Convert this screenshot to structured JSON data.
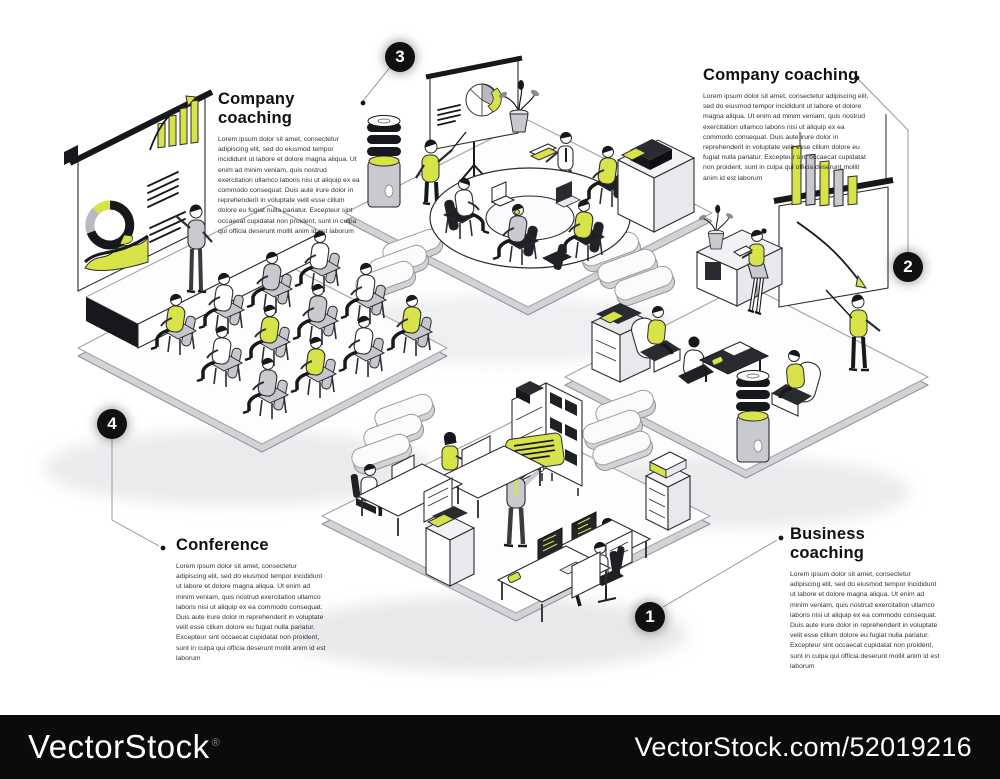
{
  "callouts": [
    {
      "number": "3",
      "title": "Company coaching",
      "body": "Lorem ipsum dolor sit amet, consectetur adipiscing elit, sed do eiusmod tempor incididunt ut labore et dolore magna aliqua. Ut enim ad minim veniam, quis nostrud exercitation ullamco laboris nisi ut aliquip ex ea commodo consequat. Duis aute irure dolor in reprehenderit in voluptate velit esse cillum dolore eu fugiat nulla pariatur. Excepteur sint occaecat cupidatat non proident, sunt in culpa qui officia deserunt mollit anim id est laborum"
    },
    {
      "number": "2",
      "title": "Company coaching",
      "body": "Lorem ipsum dolor sit amet, consectetur adipiscing elit, sed do eiusmod tempor incididunt ut labore et dolore magna aliqua. Ut enim ad minim veniam, quis nostrud exercitation ullamco laboris nisi ut aliquip ex ea commodo consequat. Duis aute irure dolor in reprehenderit in voluptate velit esse cillum dolore eu fugiat nulla pariatur. Excepteur sint occaecat cupidatat non proident, sunt in culpa qui officia deserunt mollit anim id est laborum"
    },
    {
      "number": "4",
      "title": "Conference",
      "body": "Lorem ipsum dolor sit amet, consectetur adipiscing elit, sed do eiusmod tempor incididunt ut labore et dolore magna aliqua. Ut enim ad minim veniam, quis nostrud exercitation ullamco laboris nisi ut aliquip ex ea commodo consequat. Duis aute irure dolor in reprehenderit in voluptate velit esse cillum dolore eu fugiat nulla pariatur. Excepteur sint occaecat cupidatat non proident, sunt in culpa qui officia deserunt mollit anim id est laborum"
    },
    {
      "number": "1",
      "title": "Business coaching",
      "body": "Lorem ipsum dolor sit amet, consectetur adipiscing elit, sed do eiusmod tempor incididunt ut labore et dolore magna aliqua. Ut enim ad minim veniam, quis nostrud exercitation ullamco laboris nisi ut aliquip ex ea commodo consequat. Duis aute irure dolor in reprehenderit in voluptate velit esse cillum dolore eu fugiat nulla pariatur. Excepteur sint occaecat cupidatat non proident, sunt in culpa qui officia deserunt mollit anim id est laborum"
    }
  ],
  "watermark": {
    "brand": "VectorStock",
    "registered_mark": "®",
    "site_ref": "VectorStock.com/52019216"
  },
  "colors": {
    "accent": "#d8e249",
    "ink": "#17181b"
  },
  "scene": {
    "areas": [
      "roundtable-meeting",
      "coaching-whiteboard",
      "conference-audience",
      "open-space-office"
    ]
  }
}
